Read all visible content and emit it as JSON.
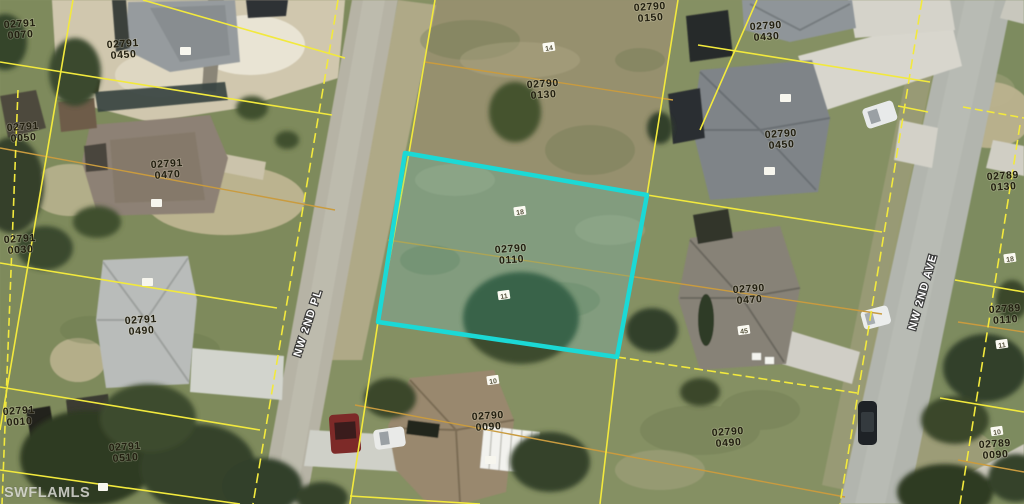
{
  "map": {
    "watermark": "SWFLAMLS",
    "highlighted_parcel_id": "02790 0110",
    "streets": [
      {
        "name": "NW 2ND PL"
      },
      {
        "name": "NW 2ND AVE"
      }
    ],
    "parcels": [
      {
        "block": "02791",
        "lot": "0070"
      },
      {
        "block": "02791",
        "lot": "0450"
      },
      {
        "block": "02790",
        "lot": "0150"
      },
      {
        "block": "02790",
        "lot": "0430"
      },
      {
        "block": "02790",
        "lot": "0130"
      },
      {
        "block": "02790",
        "lot": "0450"
      },
      {
        "block": "02789",
        "lot": "0130"
      },
      {
        "block": "02791",
        "lot": "0050"
      },
      {
        "block": "02791",
        "lot": "0470"
      },
      {
        "block": "02791",
        "lot": "0030"
      },
      {
        "block": "02790",
        "lot": "0110",
        "highlighted": true
      },
      {
        "block": "02790",
        "lot": "0470"
      },
      {
        "block": "02789",
        "lot": "0110"
      },
      {
        "block": "02791",
        "lot": "0490"
      },
      {
        "block": "02790",
        "lot": "0090"
      },
      {
        "block": "02790",
        "lot": "0490"
      },
      {
        "block": "02789",
        "lot": "0090"
      },
      {
        "block": "02791",
        "lot": "0010"
      },
      {
        "block": "02791",
        "lot": "0510"
      }
    ],
    "lot_markers": [
      "14",
      "18",
      "11",
      "10",
      "18",
      "11",
      "10",
      "45"
    ],
    "colors": {
      "parcel_line": "#f2e93d",
      "interior_line": "#c99b3f",
      "highlight": "#1bd9d6",
      "road": "#b5b4a8",
      "label_text": "#221f10"
    }
  }
}
